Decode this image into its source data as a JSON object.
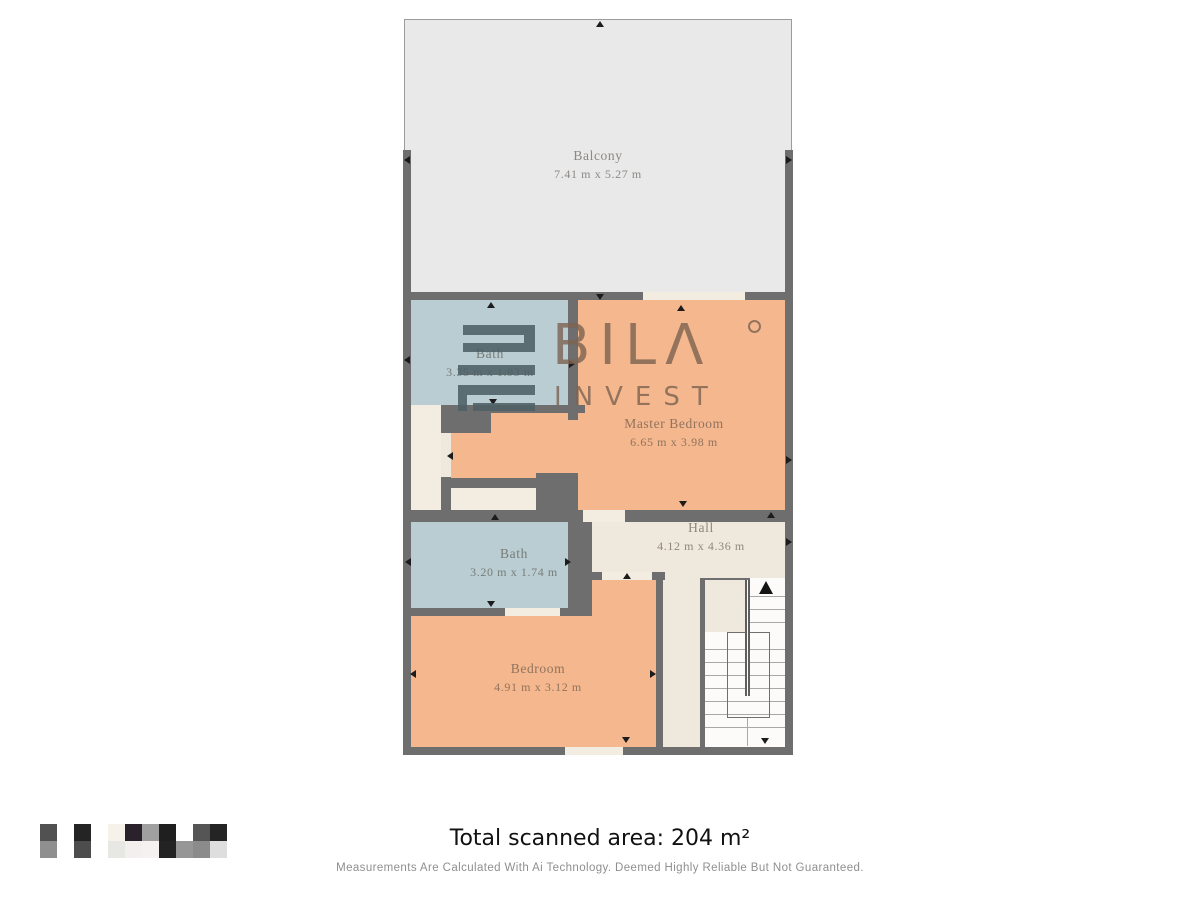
{
  "plan": {
    "colors": {
      "wall": "#6e6e6e",
      "balcony_floor": "#e9e9e9",
      "bath": "#b9cdd2",
      "bedroom": "#f5b78e",
      "hall": "#efe8dc",
      "door": "#f3ece1",
      "stairs": "#fcfbfa"
    },
    "rooms": {
      "balcony": {
        "name": "Balcony",
        "dims": "7.41 m x 5.27 m"
      },
      "bath_top": {
        "name": "Bath",
        "dims": "3.35 m x 1.93 m"
      },
      "master_bedroom": {
        "name": "Master Bedroom",
        "dims": "6.65 m x 3.98 m"
      },
      "hall": {
        "name": "Hall",
        "dims": "4.12 m x 4.36 m"
      },
      "bath_lower": {
        "name": "Bath",
        "dims": "3.20 m x 1.74 m"
      },
      "bedroom": {
        "name": "Bedroom",
        "dims": "4.91 m x 3.12 m"
      }
    }
  },
  "watermark": {
    "brand": "BILΛ",
    "sub": "INVEST",
    "text_color": "#7d6352",
    "icon_color": "#4e6066"
  },
  "footer": {
    "total_area": "Total scanned area: 204 m²",
    "disclaimer": "Measurements Are Calculated With Ai Technology. Deemed Highly Reliable But Not Guaranteed."
  },
  "scan_code": {
    "rows": [
      [
        "#515151",
        "#ffffff",
        "#242424",
        "#ffffff",
        "#f7f2e9",
        "#2a222b",
        "#a0a0a0",
        "#1f1f1f",
        "#ffffff",
        "#555555",
        "#242424"
      ],
      [
        "#8f8f8f",
        "#ffffff",
        "#4d4d4d",
        "#ffffff",
        "#e7e7e3",
        "#f3efef",
        "#f5f1f1",
        "#232323",
        "#969696",
        "#8b8b8b",
        "#dedede"
      ]
    ]
  }
}
